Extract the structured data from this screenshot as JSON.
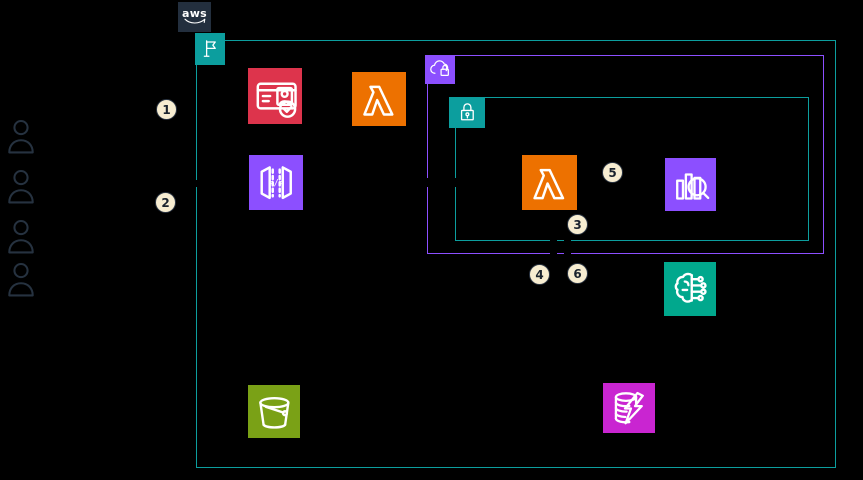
{
  "diagram": {
    "kind": "aws-architecture-diagram",
    "background_color": "#000000"
  },
  "aws_cloud": {
    "logo_text": "aws"
  },
  "groups": {
    "aws_account": {
      "icon": "flag-icon",
      "border_color": "#0C9E9E"
    },
    "vpc": {
      "icon": "cloud-lock-icon",
      "border_color": "#8C4FFF"
    },
    "private_subnet": {
      "icon": "padlock-icon",
      "border_color": "#0C9E9E"
    }
  },
  "nodes": [
    {
      "name": "users-group",
      "icon": "user-icon",
      "count": 4,
      "color": "#263240"
    },
    {
      "name": "identity-card-check",
      "icon": "id-card-check-icon",
      "color": "#DD344C"
    },
    {
      "name": "lambda-function-a",
      "icon": "lambda-icon",
      "color": "#ED7100"
    },
    {
      "name": "api-gateway",
      "icon": "code-brackets-icon",
      "color": "#8C4FFF"
    },
    {
      "name": "lambda-function-b",
      "icon": "lambda-icon",
      "color": "#ED7100"
    },
    {
      "name": "analytics-query",
      "icon": "bar-chart-magnifier-icon",
      "color": "#8C4FFF"
    },
    {
      "name": "machine-learning",
      "icon": "brain-circuit-icon",
      "color": "#01A88D"
    },
    {
      "name": "storage-bucket",
      "icon": "bucket-icon",
      "color": "#7AA116"
    },
    {
      "name": "database-lightning",
      "icon": "database-lightning-icon",
      "color": "#C925D1"
    }
  ],
  "icons": {
    "api_gateway_glyph": "</>"
  },
  "badges": [
    {
      "label": "1"
    },
    {
      "label": "2"
    },
    {
      "label": "3"
    },
    {
      "label": "4"
    },
    {
      "label": "5"
    },
    {
      "label": "6"
    }
  ],
  "colors": {
    "teal_group": "#0C9E9E",
    "purple": "#8C4FFF",
    "orange": "#ED7100",
    "red": "#DD344C",
    "green": "#7AA116",
    "magenta": "#C925D1",
    "ml_teal": "#01A88D",
    "navy": "#232F3E",
    "badge_fill": "#F7EDD1"
  }
}
